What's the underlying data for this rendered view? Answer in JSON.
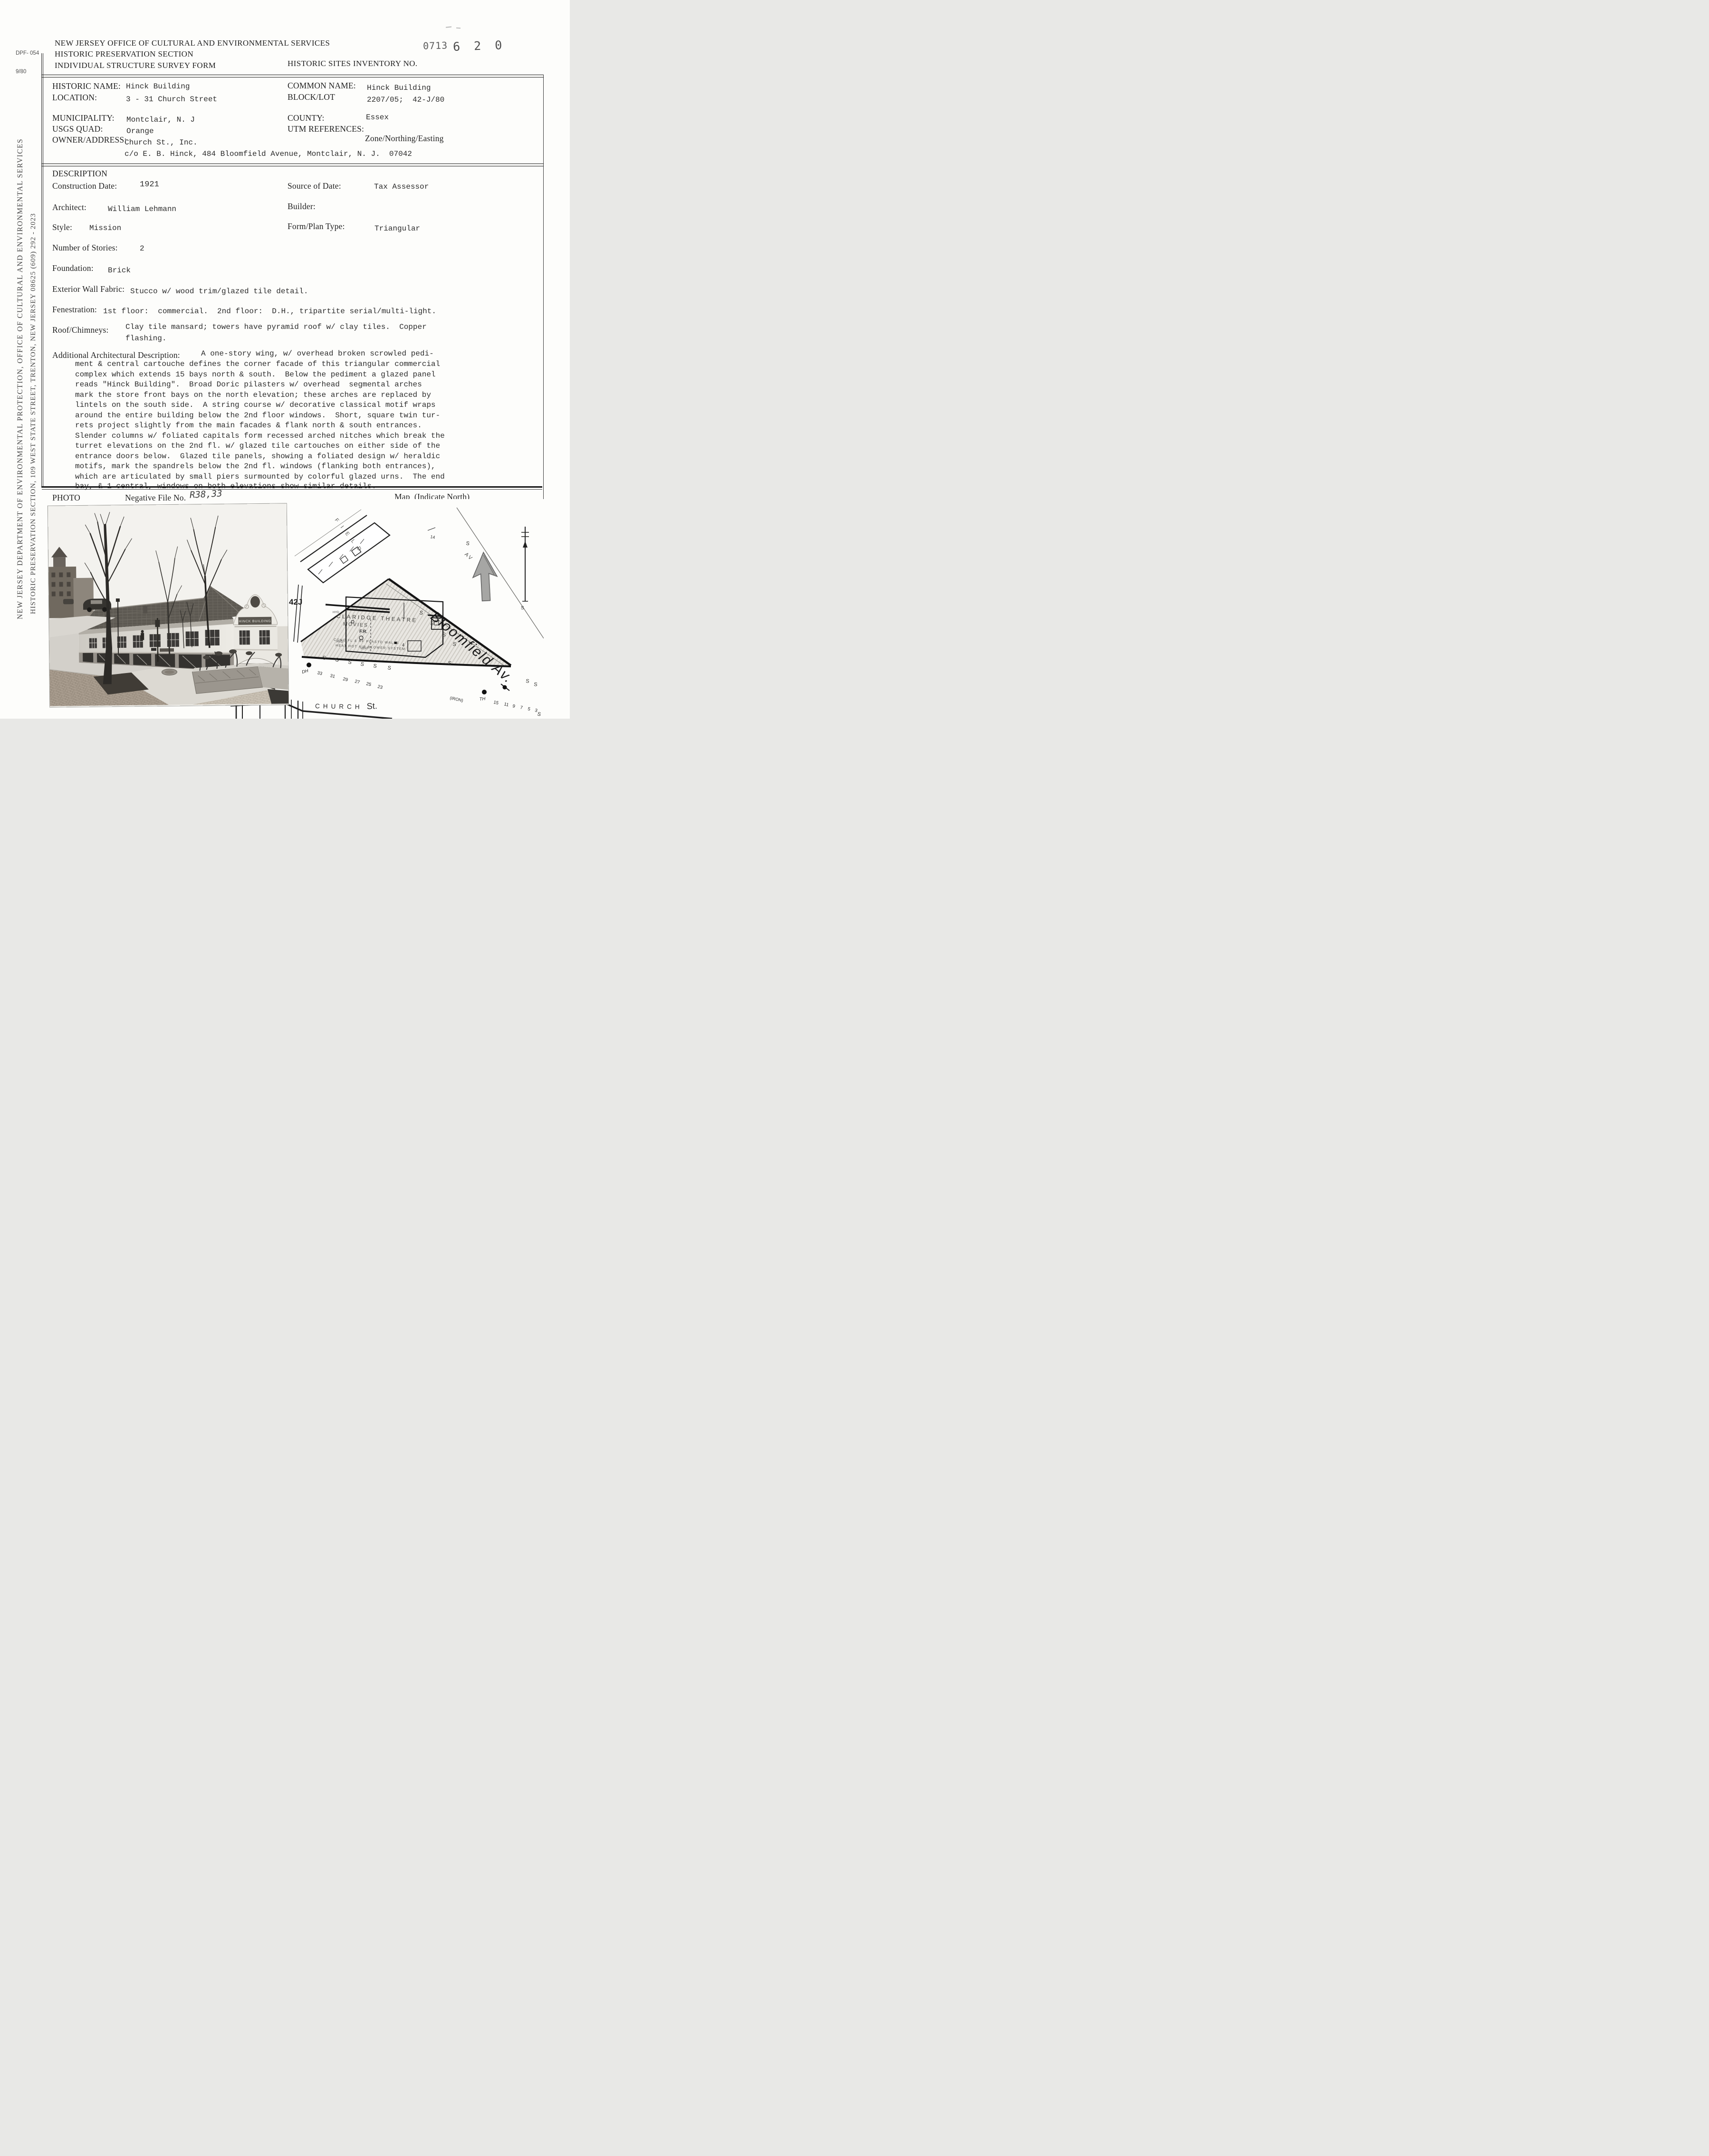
{
  "header": {
    "form_number": "DPF- 054",
    "form_date": "9/80",
    "agency_line1": "NEW JERSEY OFFICE OF CULTURAL AND ENVIRONMENTAL SERVICES",
    "agency_line2": "HISTORIC PRESERVATION SECTION",
    "agency_line3": "INDIVIDUAL STRUCTURE SURVEY FORM",
    "inventory_label": "HISTORIC SITES INVENTORY NO.",
    "stamp_prefix": "0713",
    "stamp_number": "6 2 0"
  },
  "sidebar": {
    "line1": "NEW JERSEY DEPARTMENT OF ENVIRONMENTAL PROTECTION, OFFICE OF CULTURAL AND ENVIRONMENTAL SERVICES",
    "line2": "HISTORIC PRESERVATION SECTION, 109 WEST STATE STREET, TRENTON, NEW JERSEY  08625   (609) 292 - 2023"
  },
  "identification": {
    "historic_name": {
      "label": "HISTORIC NAME:",
      "value": "Hinck Building"
    },
    "location": {
      "label": "LOCATION:",
      "value": "3 - 31 Church Street"
    },
    "common_name": {
      "label": "COMMON NAME:",
      "value": "Hinck Building"
    },
    "block_lot": {
      "label": "BLOCK/LOT",
      "value": "2207/05;  42-J/80"
    },
    "municipality": {
      "label": "MUNICIPALITY:",
      "value": "Montclair, N. J"
    },
    "county": {
      "label": "COUNTY:",
      "value": "Essex"
    },
    "usgs_quad": {
      "label": "USGS QUAD:",
      "value": "Orange"
    },
    "utm_references": {
      "label": "UTM REFERENCES:",
      "sub": "Zone/Northing/Easting"
    },
    "owner_address": {
      "label": "OWNER/ADDRESS:",
      "value": "Church St., Inc.",
      "value_line2": "c/o E. B. Hinck, 484 Bloomfield Avenue, Montclair, N. J.  07042"
    }
  },
  "description": {
    "title": "DESCRIPTION",
    "construction_date": {
      "label": "Construction Date:",
      "value": "1921"
    },
    "source_of_date": {
      "label": "Source of Date:",
      "value": "Tax Assessor"
    },
    "architect": {
      "label": "Architect:",
      "value": "William Lehmann"
    },
    "builder": {
      "label": "Builder:"
    },
    "style": {
      "label": "Style:",
      "value": "Mission"
    },
    "form_plan_type": {
      "label": "Form/Plan Type:",
      "value": "Triangular"
    },
    "number_of_stories": {
      "label": "Number of Stories:",
      "value": "2"
    },
    "foundation": {
      "label": "Foundation:",
      "value": "Brick"
    },
    "exterior_wall_fabric": {
      "label": "Exterior Wall Fabric:",
      "value": "Stucco w/ wood trim/glazed tile detail."
    },
    "fenestration": {
      "label": "Fenestration:",
      "value": "1st floor:  commercial.  2nd floor:  D.H., tripartite serial/multi-light."
    },
    "roof_chimneys": {
      "label": "Roof/Chimneys:",
      "value_line1": "Clay tile mansard; towers have pyramid roof w/ clay tiles.  Copper",
      "value_line2": "flashing."
    },
    "additional": {
      "label": "Additional Architectural Description:",
      "first_line": "A one-story wing, w/ overhead broken scrowled pedi-",
      "lines": [
        "ment & central cartouche defines the corner facade of this triangular commercial",
        "complex which extends 15 bays north & south.  Below the pediment a glazed panel",
        "reads \"Hinck Building\".  Broad Doric pilasters w/ overhead  segmental arches",
        "mark the store front bays on the north elevation; these arches are replaced by",
        "lintels on the south side.  A string course w/ decorative classical motif wraps",
        "around the entire building below the 2nd floor windows.  Short, square twin tur-",
        "rets project slightly from the main facades & flank north & south entrances.",
        "Slender columns w/ foliated capitals form recessed arched nitches which break the",
        "turret elevations on the 2nd fl. w/ glazed tile cartouches on either side of the",
        "entrance doors below.  Glazed tile panels, showing a foliated design w/ heraldic",
        "motifs, mark the spandrels below the 2nd fl. windows (flanking both entrances),",
        "which are articulated by small piers surmounted by colorful glazed urns.  The end",
        "bay, & 1 central, windows on both elevations show similar details."
      ]
    }
  },
  "photo_section": {
    "photo_label": "PHOTO",
    "negative_label": "Negative File No.",
    "negative_value": "R38,33",
    "map_label": "Map  (Indicate North)"
  },
  "photo": {
    "pediment_sign": "HINCK BUILDING",
    "store_sign_line1": "JOHN ROBERT",
    "store_sign_line2": "POWERS SCHOOL",
    "store_sign_line3": "for Women of all Ages"
  },
  "map": {
    "block_label": "42J",
    "street_printed": "FIELD",
    "street_printed_av": "AV",
    "num14": "14",
    "bloomfield": "Bloomfield Av.",
    "theatre_line1": "CLARIDGE THEATRE",
    "theatre_line2": "MOVIES",
    "theatre_line3": "F.R.",
    "theatre_number": "4",
    "note_line1": "CONC FL & RF PLASTD WALLS",
    "note_line2": "HEAT HOT AIR BLOWER SYSTEM",
    "iron_note": "(IRON)",
    "hyd_label": "HYD",
    "vent_label": "VENT",
    "church_label": "CHURCH",
    "church_st": "St.",
    "hydrant_dh": "DH",
    "hydrant_th": "TH",
    "s_mark": "S",
    "house_numbers_left": [
      "33",
      "31",
      "29",
      "27",
      "25",
      "23"
    ],
    "house_numbers_right": [
      "15",
      "11",
      "9",
      "7",
      "5",
      "3"
    ]
  }
}
